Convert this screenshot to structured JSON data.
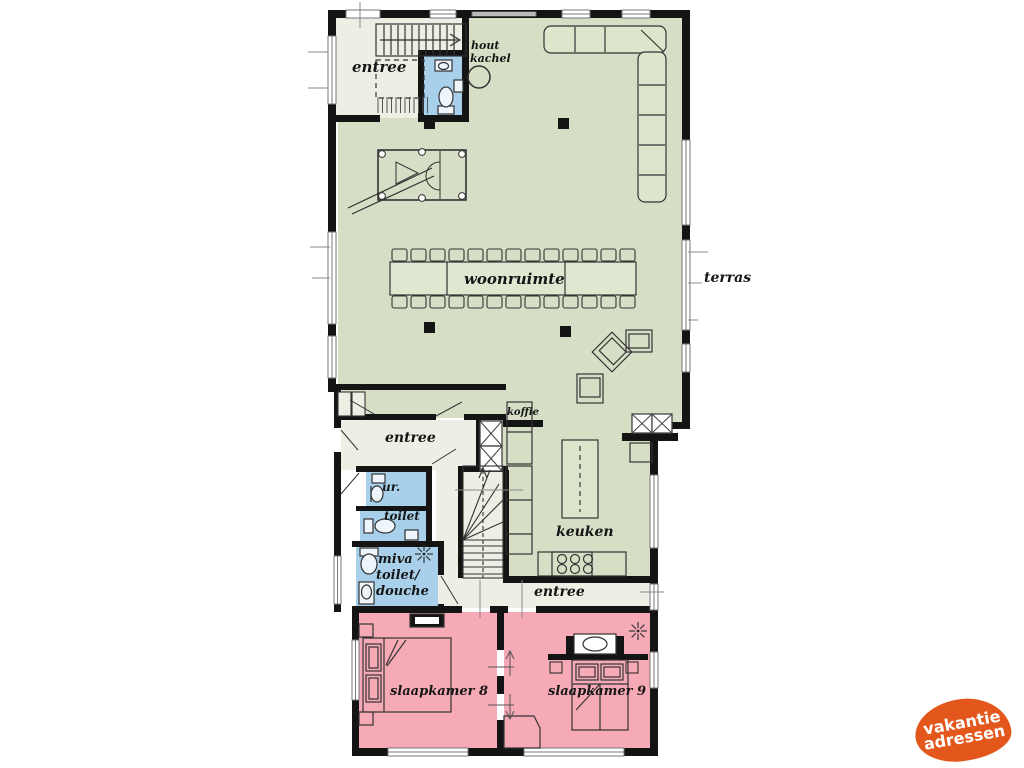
{
  "plan": {
    "rooms": {
      "entree_top": "entree",
      "woonruimte": "woonruimte",
      "keuken": "keuken",
      "entree_mid": "entree",
      "entree_low": "entree",
      "ur": "ur.",
      "toilet": "toilet",
      "miva_line1": "miva",
      "miva_line2": "toilet/",
      "miva_line3": "douche",
      "slaapkamer8": "slaapkamer 8",
      "slaapkamer9": "slaapkamer 9"
    },
    "annotations": {
      "hout_line1": "hout",
      "hout_line2": "kachel",
      "terras": "terras",
      "koffie": "koffie"
    },
    "colors": {
      "living_area": "#d6dfc6",
      "bedroom_area": "#f6aab6",
      "bathroom_area": "#a8d0ea",
      "hallway_area": "#efeee4",
      "walls": "#141414",
      "logo_orange": "#e4571c"
    }
  },
  "logo": {
    "line1": "vakantie",
    "line2": "adressen"
  }
}
